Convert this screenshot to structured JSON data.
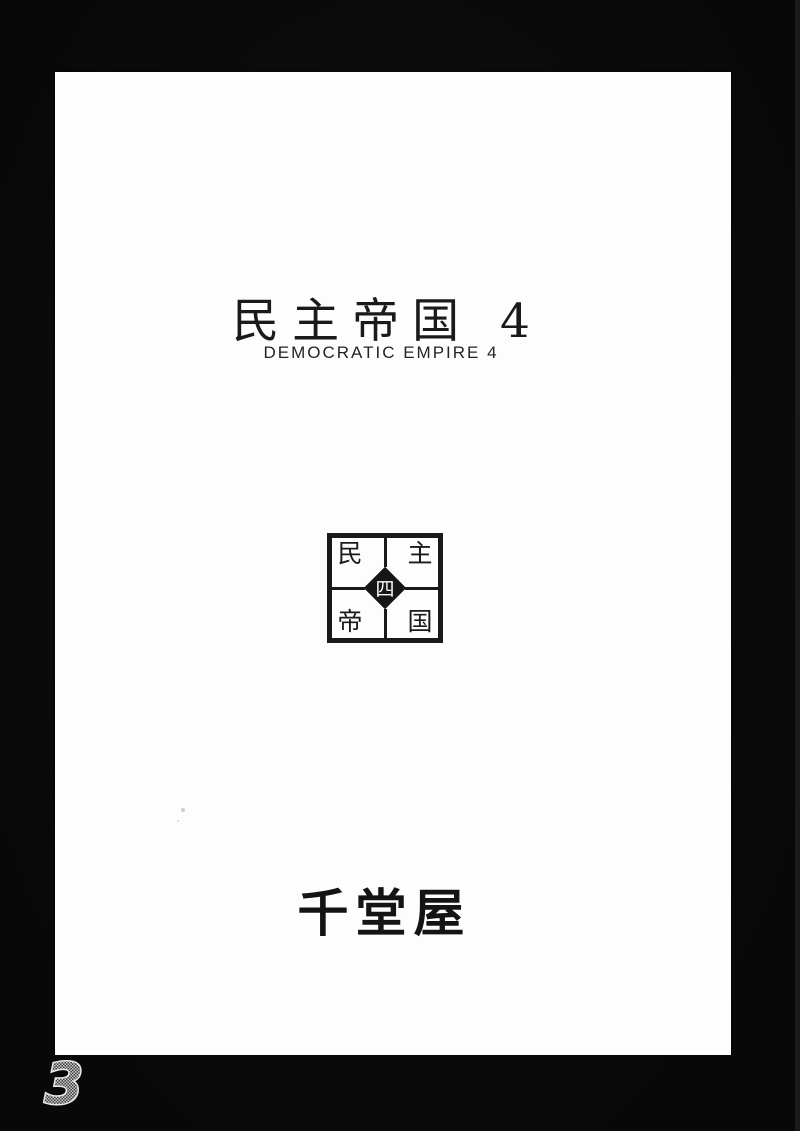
{
  "scan": {
    "background_color": "#0a0a0a",
    "paper_color": "#fdfdfd",
    "ink_color": "#1a1a1a"
  },
  "cover": {
    "title": "民主帝国 4",
    "subtitle": "DEMOCRATIC EMPIRE 4",
    "publisher": "千堂屋",
    "page_number": "3"
  },
  "logo": {
    "quadrants": [
      {
        "position": "top-left",
        "char": "民"
      },
      {
        "position": "top-right",
        "char": "主"
      },
      {
        "position": "bottom-left",
        "char": "帝"
      },
      {
        "position": "bottom-right",
        "char": "国"
      }
    ],
    "center_char": "四"
  }
}
